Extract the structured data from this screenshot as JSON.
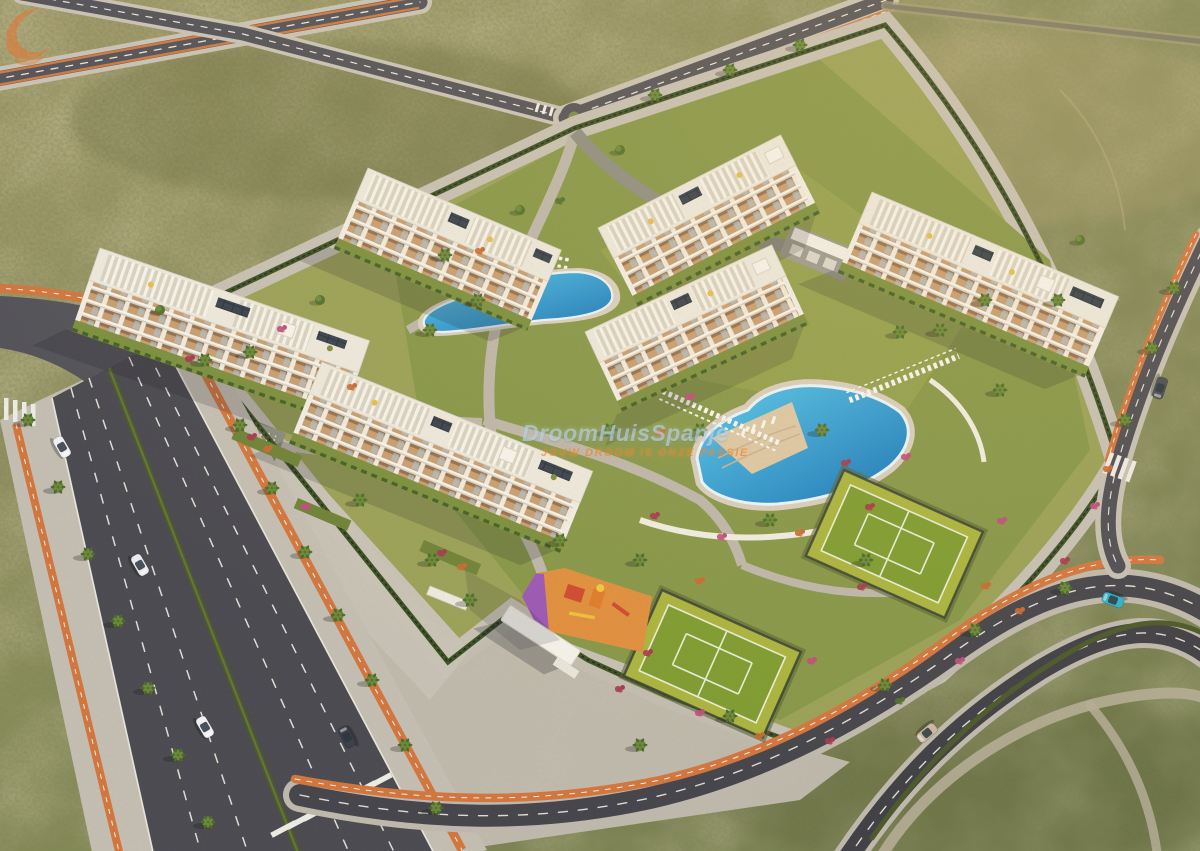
{
  "watermark": {
    "brand": "DroomHuisSpanje",
    "tagline": "JOUW DROOM IS ONZE PASSIE",
    "logo_icon": "orange-swoosh",
    "brand_text_color": "rgba(198,222,240,0.55)",
    "tagline_text_color": "rgba(232,128,44,0.62)"
  },
  "scene": {
    "setting": "Golden-hour aerial 3D render of a new white Mediterranean apartment complex on a desert scrubland plot, ringed by new avenues with terracotta bike lanes",
    "buildings": {
      "count": 6,
      "floors_visible": 4,
      "style": "white blocks with tan terraced balconies, rooftop solariums, pergolas and solar panels"
    },
    "amenities": [
      "lagoon pool with beach entry",
      "second lap pool with palm island",
      "sun lounger decks",
      "paddle court upper",
      "paddle court lower",
      "children playground orange-purple",
      "small playground",
      "bicycle parking rows",
      "carport parking",
      "entrance pavilion canopy",
      "palm-lined promenades"
    ],
    "roads": {
      "style": "dark asphalt, white dashed lanes, hedge medians, zebra crossings",
      "bike_lane_color": "#d2763f"
    },
    "vehicles": {
      "count": 7,
      "colors": [
        "white",
        "white",
        "white",
        "dark-grey",
        "beige",
        "teal",
        "dark-grey"
      ]
    },
    "palette": {
      "desert": "#8d8c5f",
      "asphalt": "#4c4b51",
      "sidewalk": "#c4beb2",
      "lawn": "#87974a",
      "pool_water": "#2f9fd4",
      "court_green": "#7f9c32",
      "court_border": "#aab43f",
      "playground_orange": "#df8f3f",
      "playground_purple": "#9c58b5",
      "building_white": "#f1ede4",
      "balcony_tan": "#c79e72",
      "hedge": "#3d5226",
      "bougainvillea": [
        "#a93a50",
        "#bf4f7d",
        "#c96a33"
      ]
    }
  }
}
